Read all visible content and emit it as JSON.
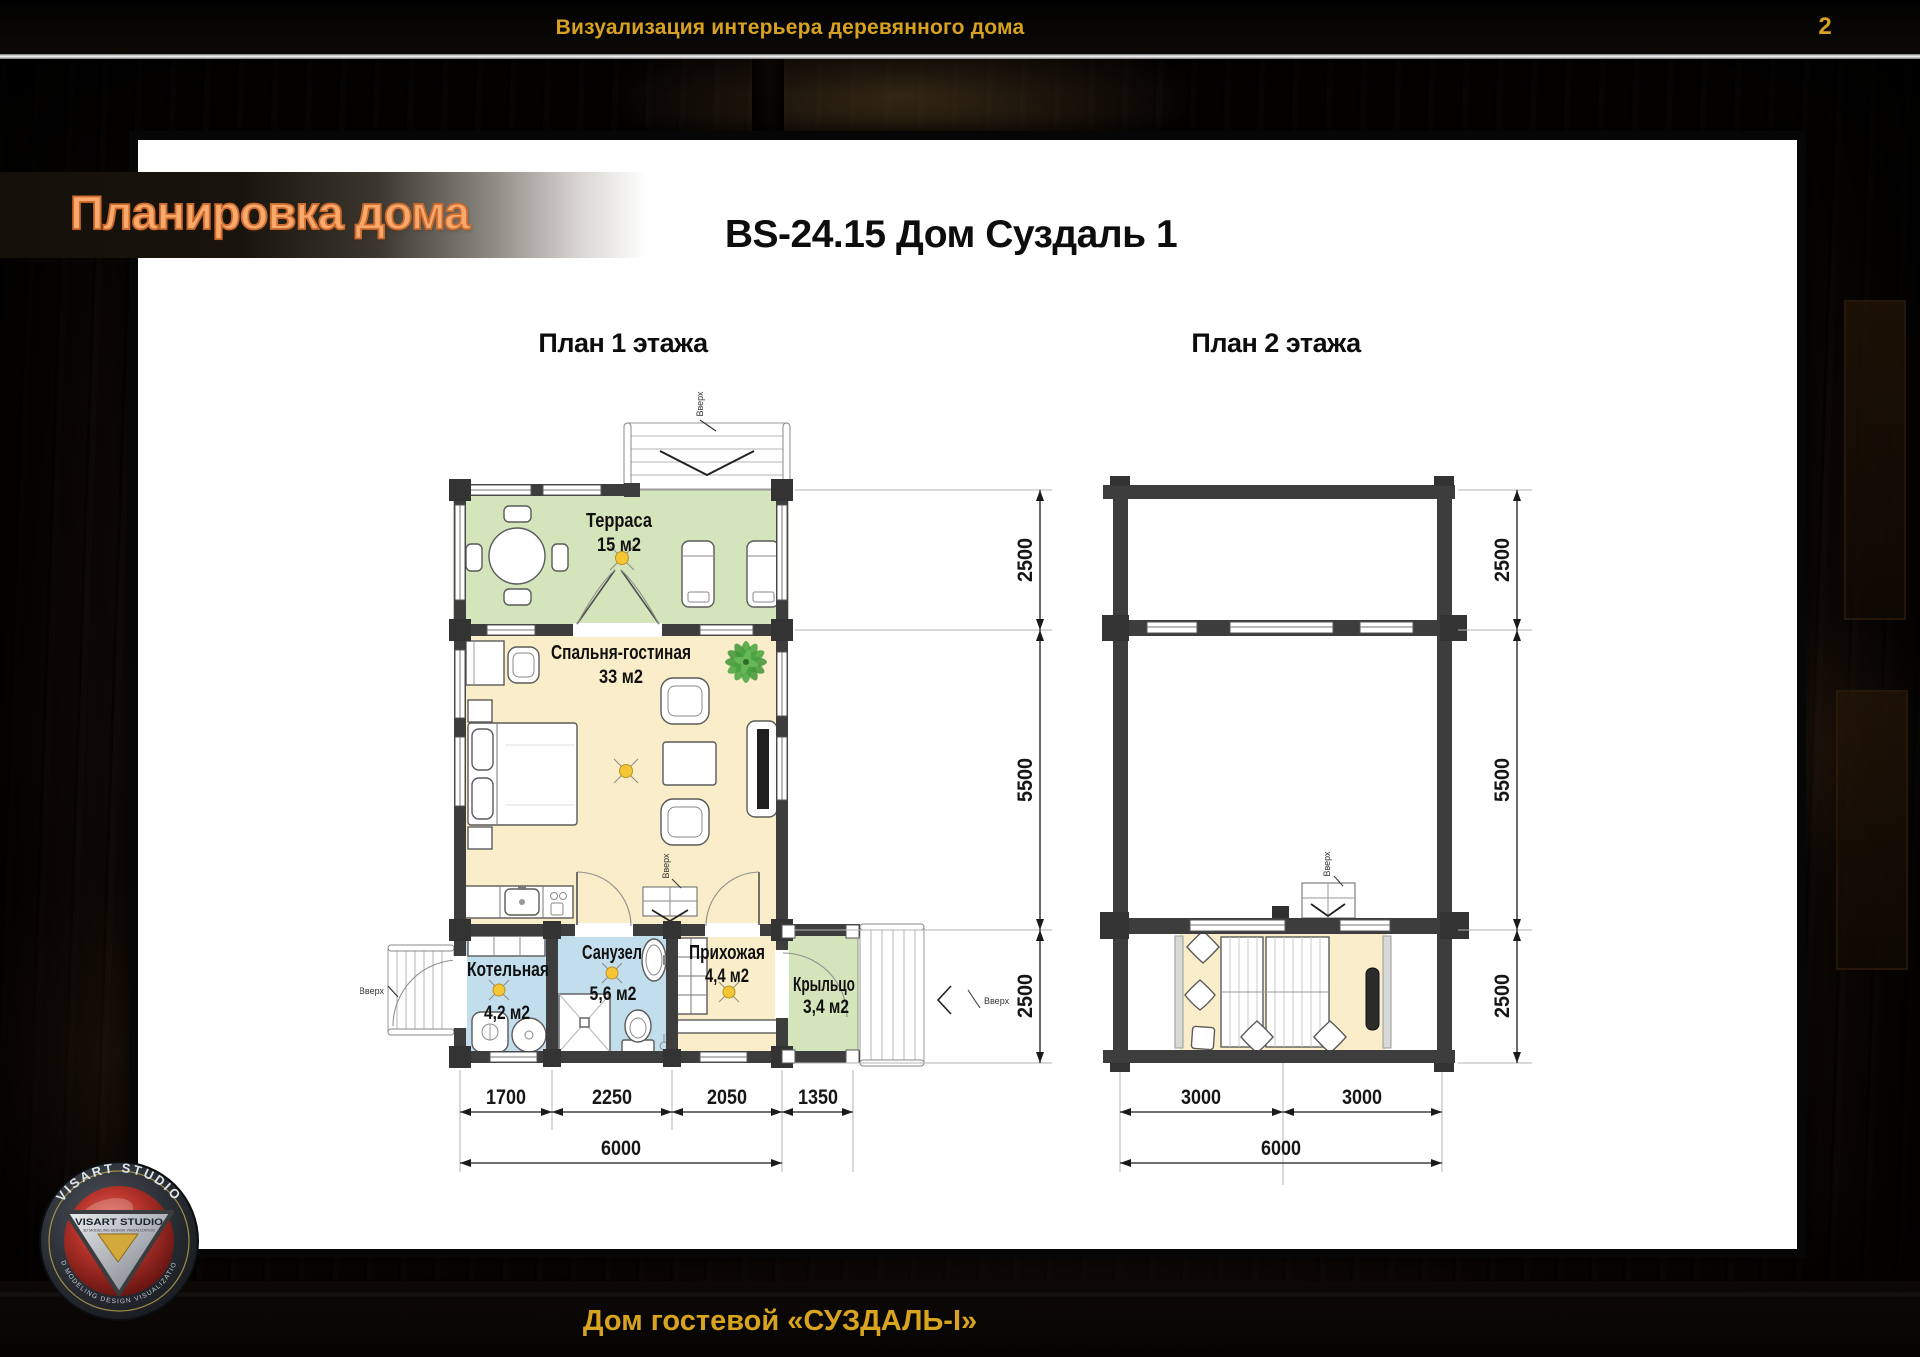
{
  "colors": {
    "accent_gold": "#d7a21f",
    "banner_text_orange": "#f8a96b",
    "terrace_green": "#d5e5bb",
    "room_cream": "#faeeca",
    "wet_room_blue": "#c2deec",
    "wall_dark": "#3d3d3d",
    "slide_bg": "#ffffff"
  },
  "top_bar": {
    "title": "Визуализация интерьера деревянного дома",
    "page_number": "2"
  },
  "banner": {
    "title": "Планировка дома"
  },
  "slide": {
    "heading": "BS-24.15 Дом Суздаль 1"
  },
  "plan1": {
    "caption": "План 1 этажа",
    "up_label": "Вверх",
    "rooms": [
      {
        "name": "Терраса",
        "area": "15 м2"
      },
      {
        "name": "Спальня-гостиная",
        "area": "33 м2"
      },
      {
        "name": "Котельная",
        "area": "4,2 м2"
      },
      {
        "name": "Санузел",
        "area": "5,6 м2"
      },
      {
        "name": "Прихожая",
        "area": "4,4 м2"
      },
      {
        "name": "Крыльцо",
        "area": "3,4 м2"
      }
    ],
    "dims_width": [
      "1700",
      "2250",
      "2050",
      "1350"
    ],
    "dims_height": [
      "2500",
      "5500",
      "2500"
    ],
    "dim_total": "6000"
  },
  "plan2": {
    "caption": "План 2 этажа",
    "up_label": "Вверх",
    "dims_width": [
      "3000",
      "3000"
    ],
    "dims_height": [
      "2500",
      "5500",
      "2500"
    ],
    "dim_total": "6000"
  },
  "footer": {
    "title": "Дом гостевой «СУЗДАЛЬ-I»"
  },
  "logo": {
    "arc_top": "VISART STUDIO",
    "arc_bottom": "3D MODELING DESIGN VISUALIZATION",
    "triangle_title": "VISART STUDIO",
    "triangle_subtitle": "3D MODELING DESIGN VISUALIZATION"
  }
}
